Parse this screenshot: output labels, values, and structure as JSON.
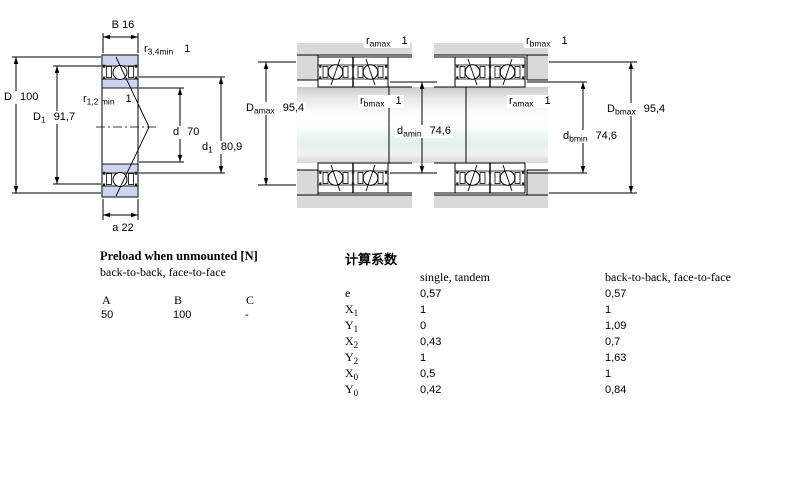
{
  "colors": {
    "ring_blue": "#ccd4ef",
    "housing_gray": "#d9d9d9",
    "line": "#000000"
  },
  "drawing": {
    "left": {
      "dim_B": "B 16",
      "r_top": {
        "base": "r",
        "sub": "3,4min",
        "note": "1"
      },
      "dim_D": {
        "base": "D",
        "sub": "",
        "value": "100"
      },
      "dim_D1": {
        "base": "D",
        "sub": "1",
        "value": "91,7"
      },
      "r_mid": {
        "base": "r",
        "sub": "1,2 min",
        "note": "1"
      },
      "dim_d": {
        "base": "d",
        "sub": "",
        "value": "70"
      },
      "dim_d1": {
        "base": "d",
        "sub": "1",
        "value": "80,9"
      },
      "dim_a": "a 22"
    },
    "middle": {
      "r_top": {
        "base": "r",
        "sub": "amax",
        "note": "1"
      },
      "dim_D": {
        "base": "D",
        "sub": "amax",
        "value": "95,4"
      },
      "r_mid": {
        "base": "r",
        "sub": "bmax",
        "note": "1"
      },
      "dim_d": {
        "base": "d",
        "sub": "amin",
        "value": "74,6"
      }
    },
    "right": {
      "r_top": {
        "base": "r",
        "sub": "bmax",
        "note": "1"
      },
      "r_mid": {
        "base": "r",
        "sub": "amax",
        "note": "1"
      },
      "dim_d": {
        "base": "d",
        "sub": "bmin",
        "value": "74,6"
      },
      "dim_D": {
        "base": "D",
        "sub": "bmax",
        "value": "95,4"
      }
    }
  },
  "preload": {
    "title": "Preload when unmounted [N]",
    "subtitle": "back-to-back, face-to-face",
    "headers": [
      "A",
      "B",
      "C"
    ],
    "values": [
      "50",
      "100",
      "-"
    ]
  },
  "factors": {
    "title": "计算系数",
    "col1": "single, tandem",
    "col2": "back-to-back, face-to-face",
    "rows": [
      {
        "base": "e",
        "sub": "",
        "v1": "0,57",
        "v2": "0,57"
      },
      {
        "base": "X",
        "sub": "1",
        "v1": "1",
        "v2": "1"
      },
      {
        "base": "Y",
        "sub": "1",
        "v1": "0",
        "v2": "1,09"
      },
      {
        "base": "X",
        "sub": "2",
        "v1": "0,43",
        "v2": "0,7"
      },
      {
        "base": "Y",
        "sub": "2",
        "v1": "1",
        "v2": "1,63"
      },
      {
        "base": "X",
        "sub": "0",
        "v1": "0,5",
        "v2": "1"
      },
      {
        "base": "Y",
        "sub": "0",
        "v1": "0,42",
        "v2": "0,84"
      }
    ]
  }
}
